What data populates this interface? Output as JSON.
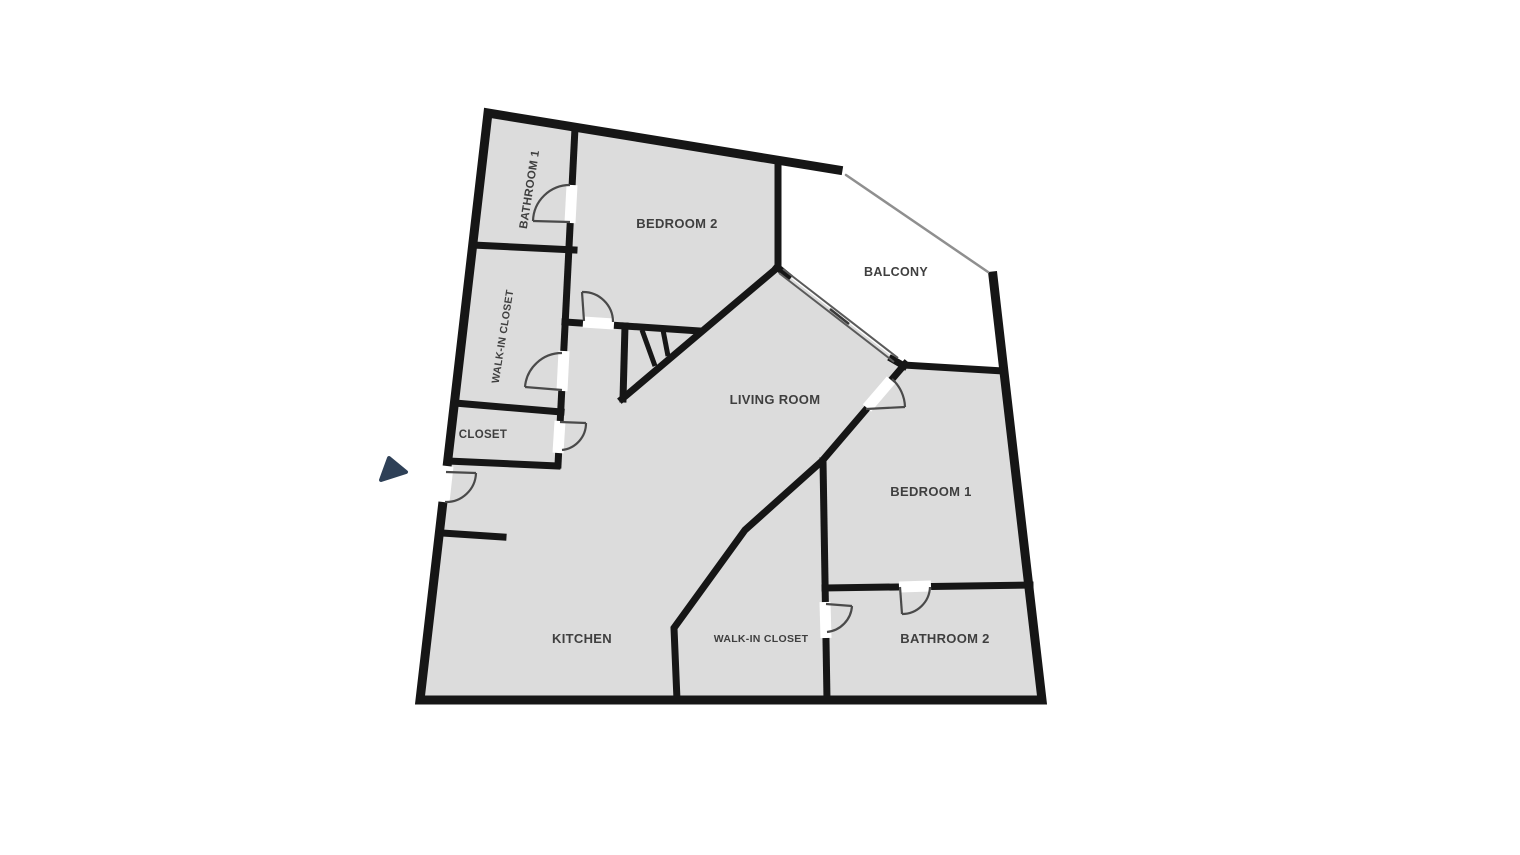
{
  "floorplan": {
    "rooms": [
      {
        "id": "bathroom-1",
        "label": "BATHROOM 1"
      },
      {
        "id": "walk-in-closet-upper",
        "label": "WALK-IN CLOSET"
      },
      {
        "id": "closet",
        "label": "CLOSET"
      },
      {
        "id": "bedroom-2",
        "label": "BEDROOM 2"
      },
      {
        "id": "balcony",
        "label": "BALCONY"
      },
      {
        "id": "living-room",
        "label": "LIVING ROOM"
      },
      {
        "id": "bedroom-1",
        "label": "BEDROOM 1"
      },
      {
        "id": "kitchen",
        "label": "KITCHEN"
      },
      {
        "id": "walk-in-closet-lower",
        "label": "WALK-IN CLOSET"
      },
      {
        "id": "bathroom-2",
        "label": "BATHROOM 2"
      }
    ],
    "colors": {
      "room_fill": "#dcdcdc",
      "wall": "#161616",
      "door": "#4a4a4a",
      "railing": "#8f8f8f",
      "label": "#3f3f3f",
      "entry_arrow": "#2e4057",
      "background": "#ffffff"
    }
  }
}
